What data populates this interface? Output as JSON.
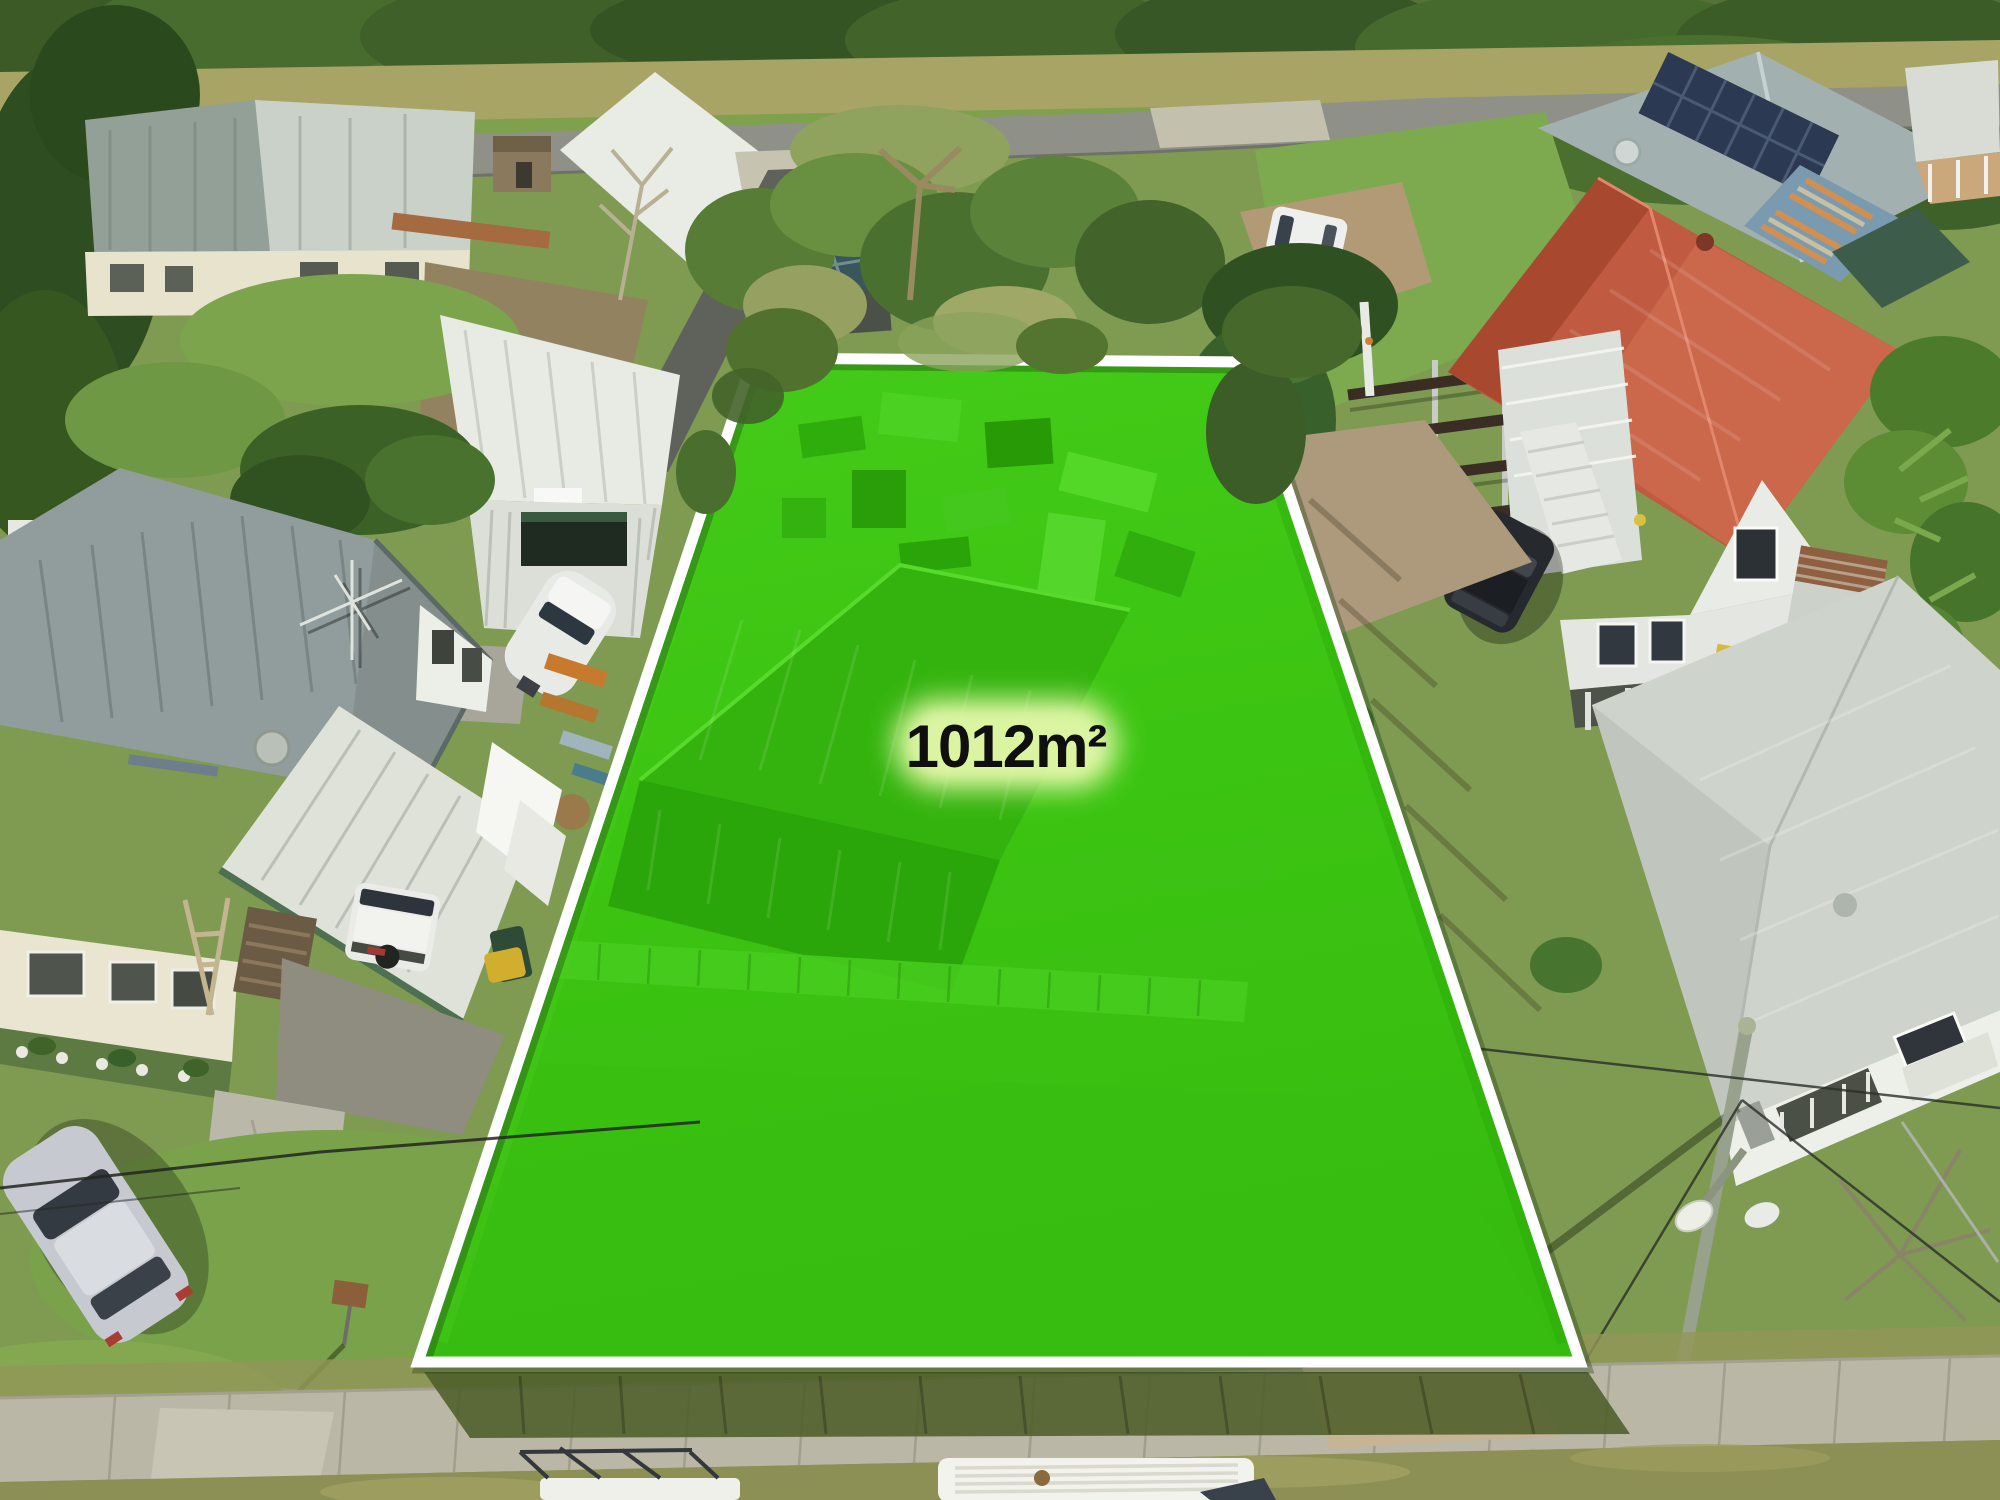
{
  "lot": {
    "area_label": "1012m²",
    "overlay_color": "#3ec613",
    "border_color": "#ffffff",
    "label_color": "#0f0f0f",
    "halo_color": "#dcf5a3"
  },
  "palette": {
    "grass_base": "#7e9b51",
    "road_asphalt": "#8f9189",
    "footpath_concrete": "#bab7a6",
    "verge_grass": "#8d9054",
    "dirt_driveway": "#b6a387",
    "red_roof": "#c05a40",
    "grey_roof": "#919d9c",
    "shed_roof_white": "#e8eae4",
    "tree_dark": "#3b5a26"
  }
}
